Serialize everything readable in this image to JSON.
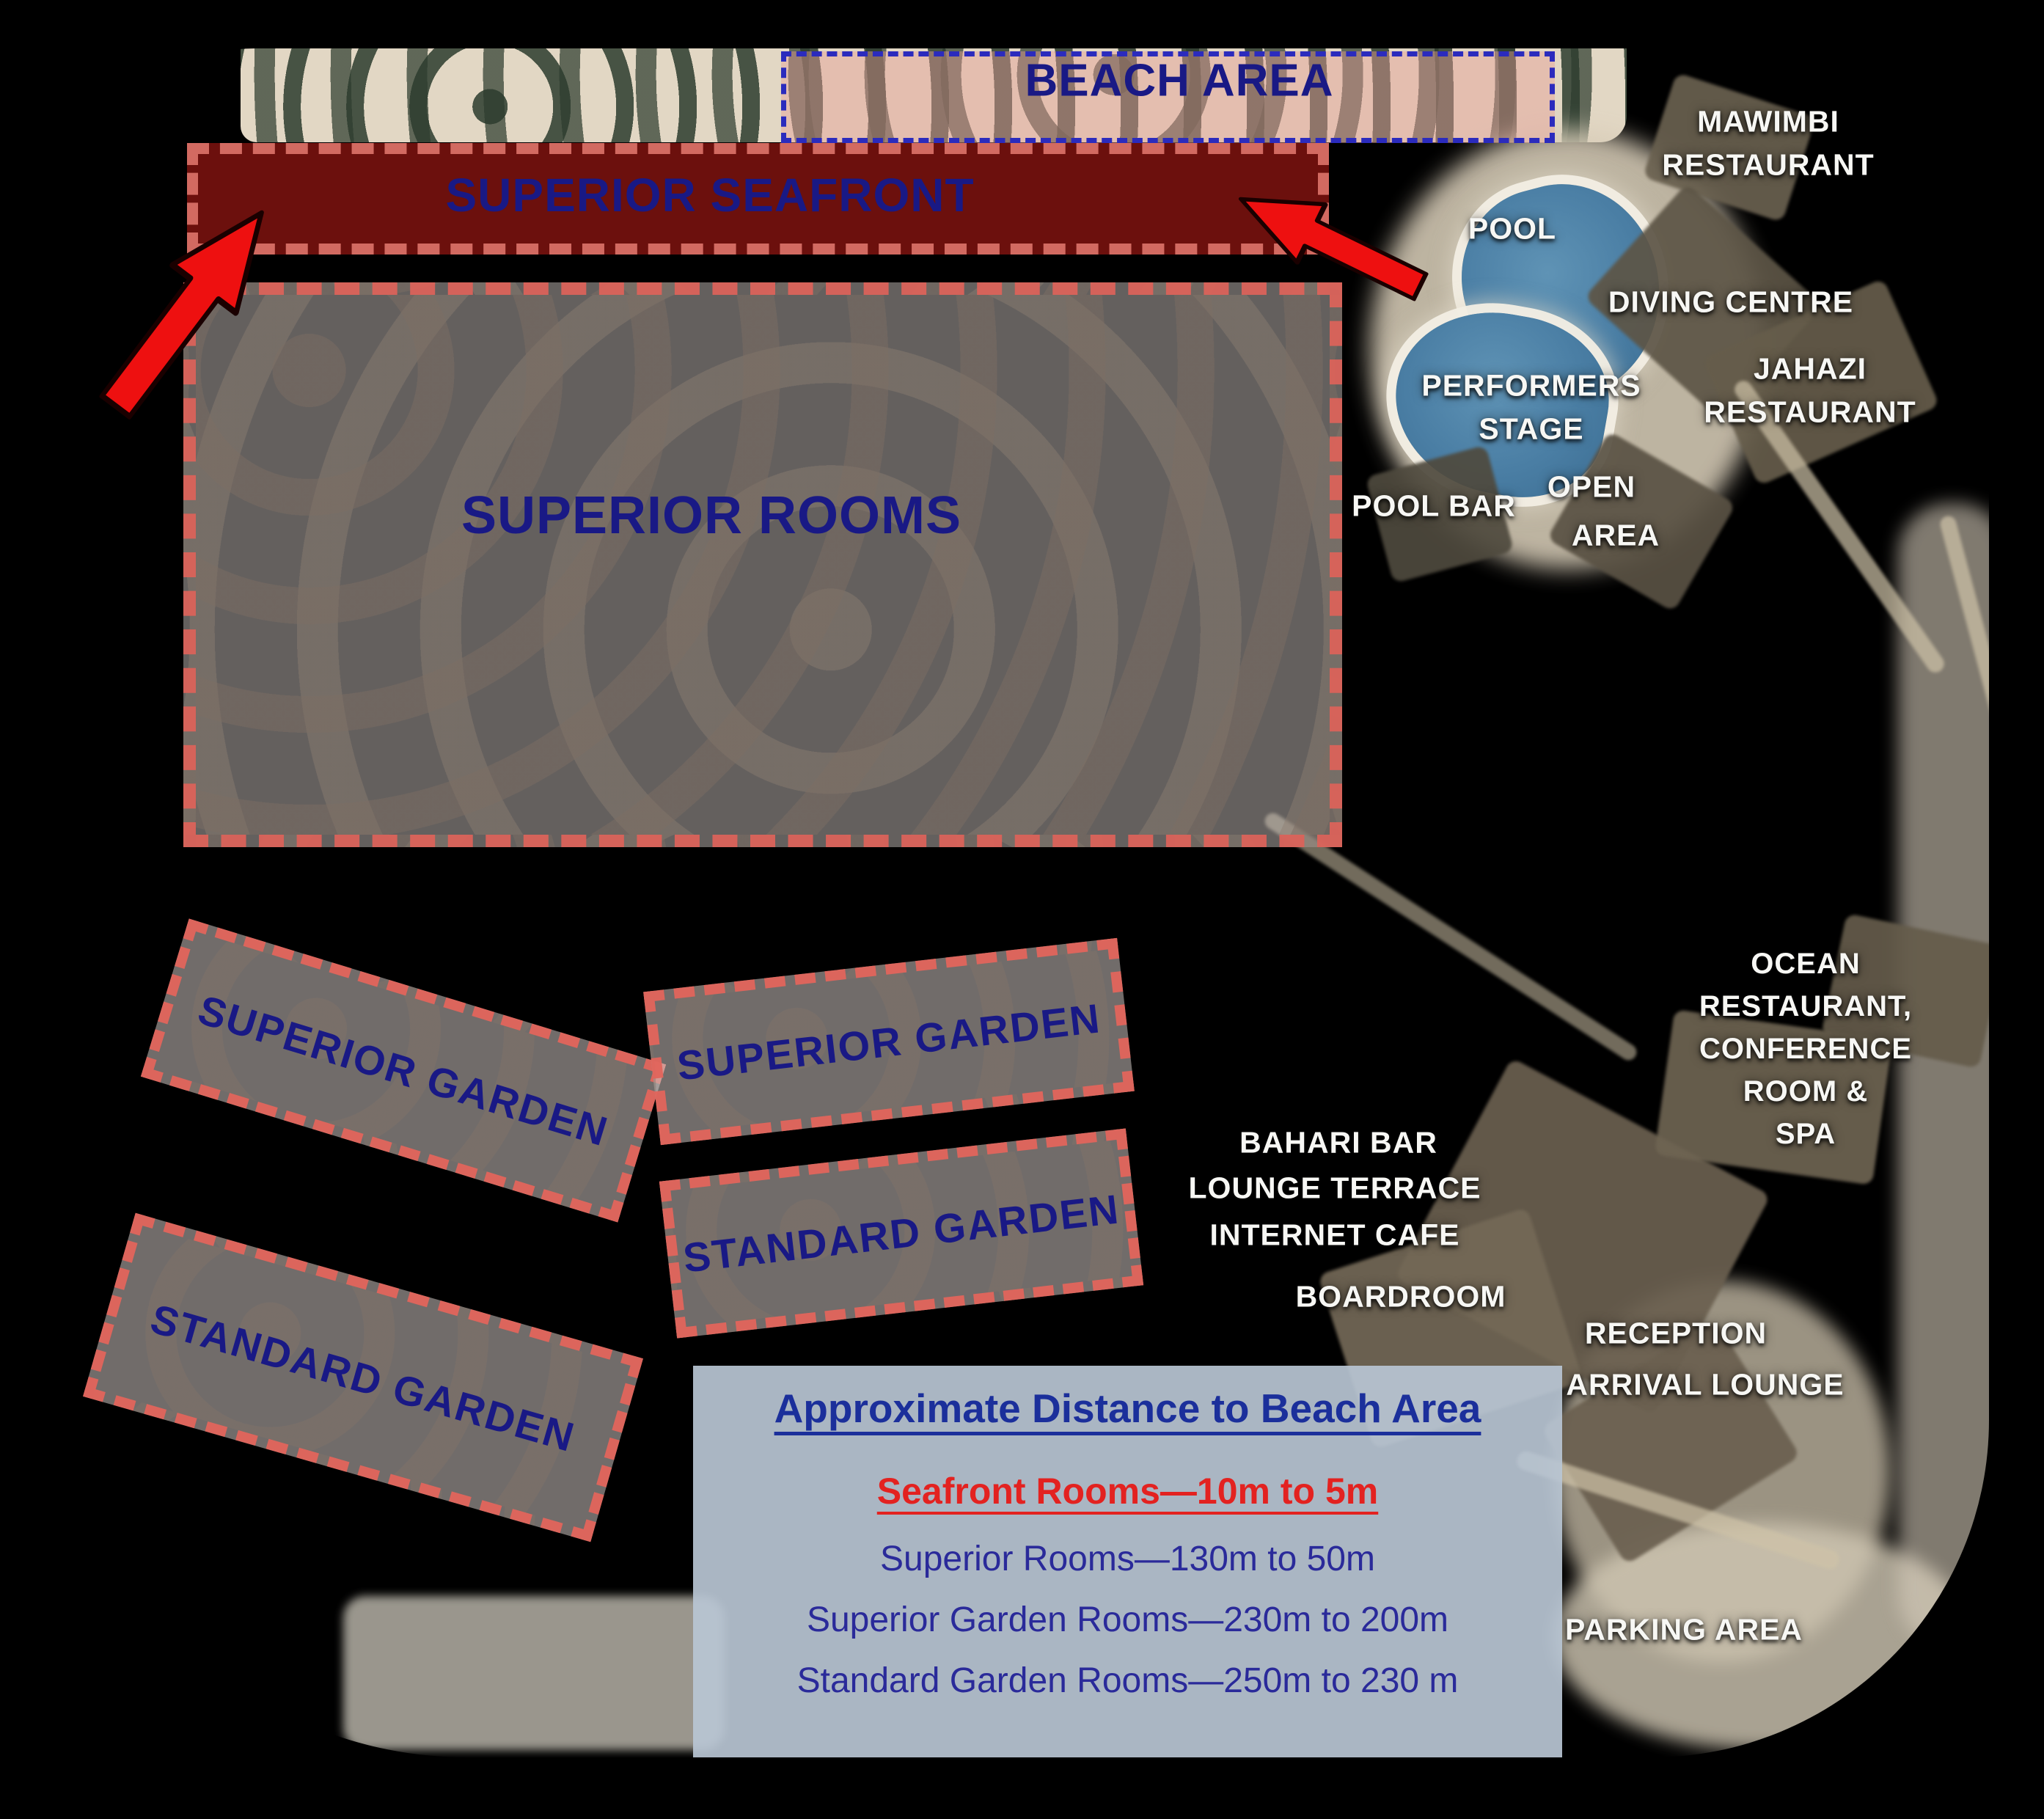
{
  "regions": {
    "beach_area": "BEACH AREA",
    "superior_seafront": "SUPERIOR SEAFRONT",
    "superior_rooms": "SUPERIOR ROOMS",
    "superior_garden": "SUPERIOR GARDEN",
    "standard_garden": "STANDARD GARDEN"
  },
  "facilities": {
    "pool": "POOL",
    "mawimbi_restaurant": "MAWIMBI\nRESTAURANT",
    "diving_centre": "DIVING CENTRE",
    "performers_stage": "PERFORMERS\nSTAGE",
    "jahazi_restaurant": "JAHAZI\nRESTAURANT",
    "pool_bar": "POOL BAR",
    "open_area_line1": "OPEN",
    "open_area_line2": "AREA",
    "ocean_restaurant_block": "OCEAN RESTAURANT,\nCONFERENCE ROOM &\nSPA",
    "bahari_bar": "BAHARI BAR",
    "lounge_terrace": "LOUNGE TERRACE",
    "internet_cafe": "INTERNET CAFE",
    "boardroom": "BOARDROOM",
    "reception": "RECEPTION",
    "arrival_lounge": "ARRIVAL LOUNGE",
    "parking_area": "PARKING AREA"
  },
  "legend": {
    "title": "Approximate Distance to Beach Area",
    "lines": [
      "Seafront Rooms—10m to 5m",
      "Superior Rooms—130m to 50m",
      "Superior Garden Rooms—230m to 200m",
      "Standard Garden Rooms—250m to 230 m"
    ]
  },
  "colors": {
    "navy_text": "#191985",
    "seafront_fill": "#c41e18",
    "dash_red": "#db625a",
    "dash_blue": "#2b2bbd",
    "beach_fill_pink": "#e7a096",
    "legend_bg": "#b8c5d4",
    "legend_red": "#e32220",
    "white_label": "#f7f7f4",
    "arrow_red": "#ee1010"
  }
}
